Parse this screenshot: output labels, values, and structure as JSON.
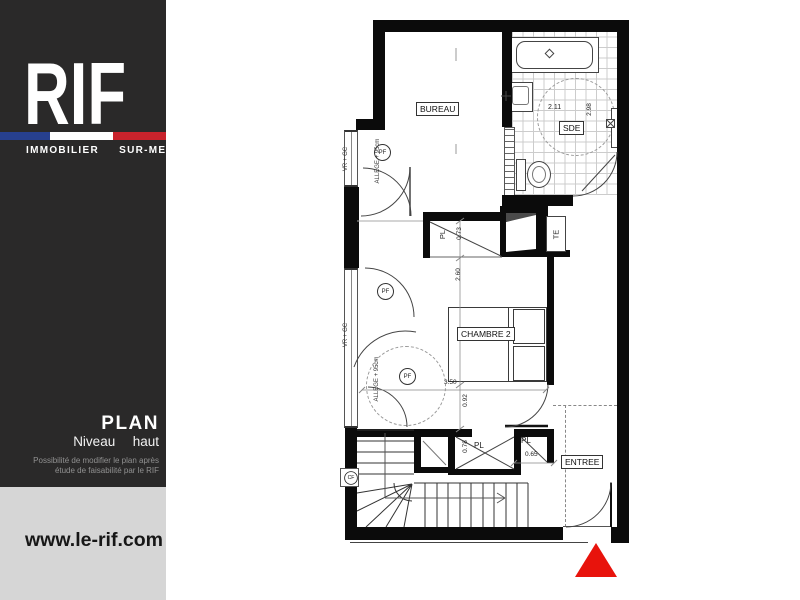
{
  "sidebar": {
    "logo_text": "RIF",
    "tagline": "IMMOBILIER  SUR-MESURE",
    "flag_blue": "#27408f",
    "flag_white": "#ffffff",
    "flag_red": "#c8232c",
    "plan_title": "PLAN",
    "plan_subtitle": "Niveau  haut",
    "note_line1": "Possibilité de modifier le plan après",
    "note_line2": "étude de faisabilité par le RIF",
    "website": "www.le-rif.com"
  },
  "plan": {
    "rooms": {
      "bureau": "BUREAU",
      "sde": "SDE",
      "chambre2": "CHAMBRE 2",
      "entree": "ENTREE"
    },
    "closets": {
      "pl_upper": "PL",
      "pl_middle": "PL",
      "pl_right": "PL",
      "te": "TE"
    },
    "dimensions": {
      "sde_width": "2.11",
      "sde_height": "2.98",
      "pl_upper_depth": "0.73",
      "chambre_length": "2.60",
      "door_passage": "0.92",
      "chambre_width": "3.50",
      "pl_middle_depth": "0.78",
      "pl_right_width": "0.65"
    },
    "markers": {
      "pf": "PF",
      "cf": "CF"
    },
    "window_labels": {
      "vr_gc": "VR + GC",
      "allege": "ALLEGE + 95cm"
    },
    "north_arrow_color": "#e8130c"
  }
}
